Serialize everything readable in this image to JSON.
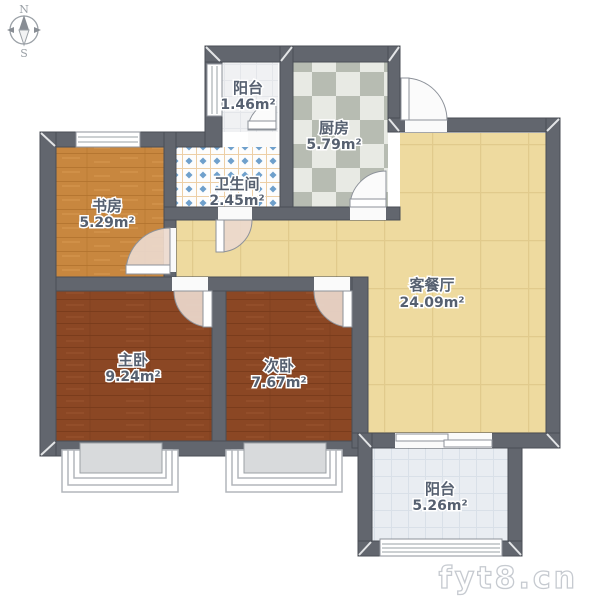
{
  "compass": {
    "north": "N",
    "south": "S"
  },
  "rooms": [
    {
      "id": "balcony-north",
      "name": "阳台",
      "area": "1.46m²"
    },
    {
      "id": "kitchen",
      "name": "厨房",
      "area": "5.79m²"
    },
    {
      "id": "bathroom",
      "name": "卫生间",
      "area": "2.45m²"
    },
    {
      "id": "study",
      "name": "书房",
      "area": "5.29m²"
    },
    {
      "id": "living-dining",
      "name": "客餐厅",
      "area": "24.09m²"
    },
    {
      "id": "master-bedroom",
      "name": "主卧",
      "area": "9.24m²"
    },
    {
      "id": "second-bedroom",
      "name": "次卧",
      "area": "7.67m²"
    },
    {
      "id": "balcony-south",
      "name": "阳台",
      "area": "5.26m²"
    }
  ],
  "watermark": {
    "text": "fyt8.cn"
  },
  "colors": {
    "wall": "#62666e",
    "wall-stroke": "#4a4e55",
    "study-floor": "#c8873f",
    "study-grain": "#b0712c",
    "bedroom-floor": "#8b4724",
    "bedroom-grain": "#76391b",
    "living-floor": "#eeda9f",
    "living-grid": "#e1ca8c",
    "kitchen-light": "#e8eae4",
    "kitchen-dark": "#b7bcb2",
    "bath-base": "#fdfdfd",
    "bath-grid": "#edcfa6",
    "bath-dot": "#6fa0cc",
    "balcony-north-floor": "#f0f1f3",
    "balcony-north-grid": "#e4e6ea",
    "balcony-south-floor": "#e9edf2",
    "balcony-south-grid": "#d9e0e8",
    "door-swing": "#ecd9cd",
    "label": "#566070",
    "watermark": "#c6cad0",
    "compass": "#9aa0a6",
    "compass-needle": "#888d94"
  }
}
